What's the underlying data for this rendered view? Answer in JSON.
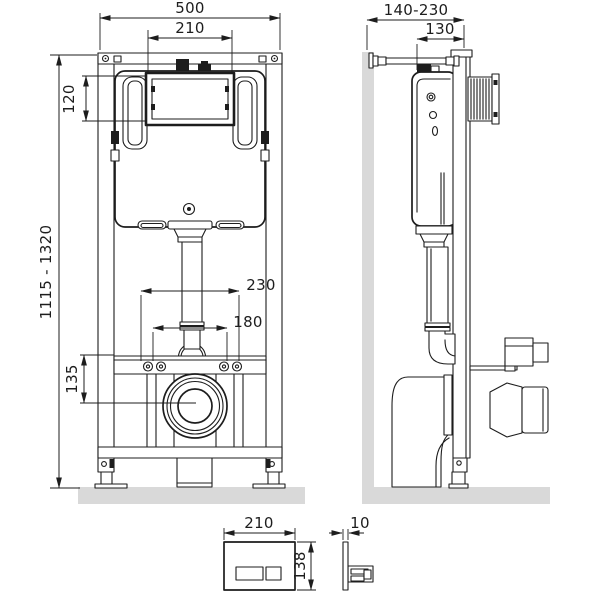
{
  "drawing": {
    "front_view": {
      "overall_width": "500",
      "access_window_width": "210",
      "access_window_height": "120",
      "frame_height_range": "1115 - 1320",
      "drain_center_height": "135",
      "fixing_bolt_spacing_wide": "230",
      "fixing_bolt_spacing_narrow": "180"
    },
    "side_view": {
      "installation_depth_range": "140-230",
      "frame_depth": "130"
    },
    "flush_plate": {
      "width": "210",
      "height": "138",
      "thickness": "10"
    }
  },
  "colors": {
    "line": "#1d1d1d",
    "surface": "#d9d9d9",
    "background": "#ffffff"
  }
}
